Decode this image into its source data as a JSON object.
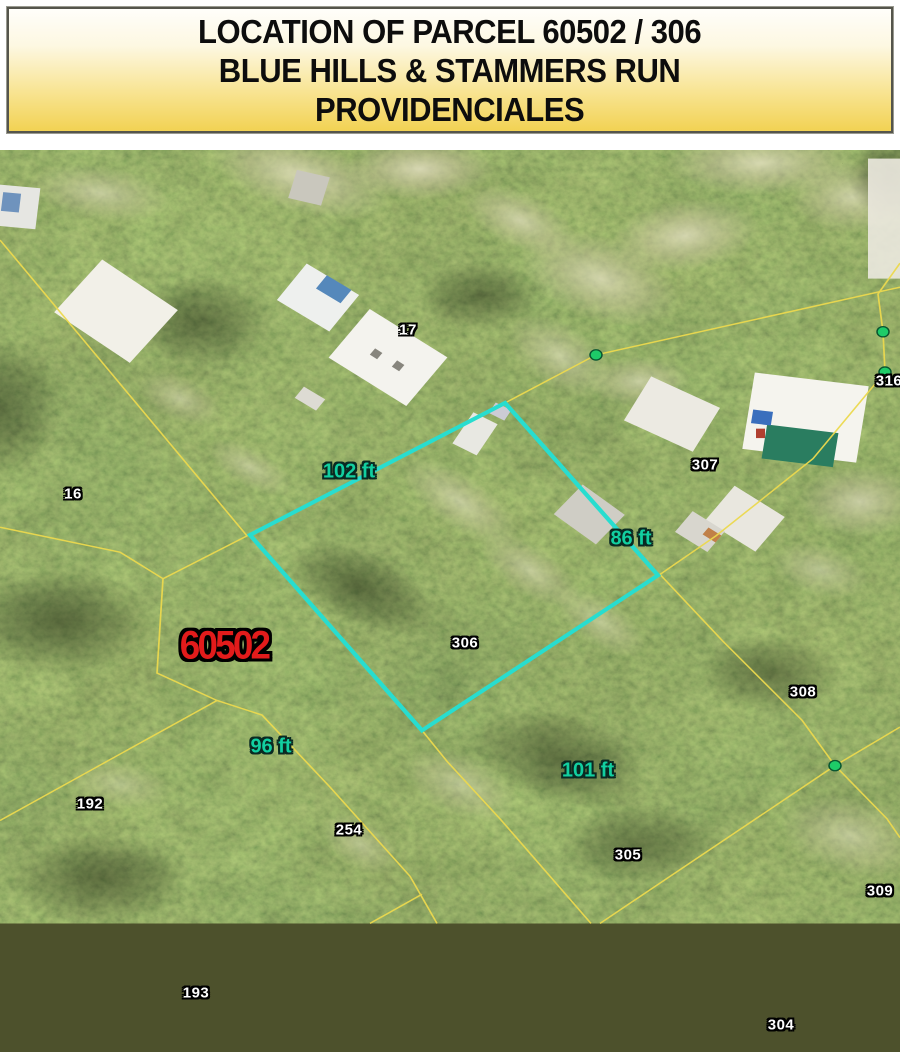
{
  "banner": {
    "line1": "LOCATION OF PARCEL 60502 / 306",
    "line2": "BLUE HILLS & STAMMERS RUN",
    "line3": "PROVIDENCIALES"
  },
  "map": {
    "parcel_id": "60502",
    "parcel_numbers": {
      "p16": "16",
      "p17": "17",
      "p192": "192",
      "p193": "193",
      "p254": "254",
      "p304": "304",
      "p305": "305",
      "p306": "306",
      "p307": "307",
      "p308": "308",
      "p309": "309",
      "p316": "316"
    },
    "measurements": {
      "top": "102 ft",
      "right": "86 ft",
      "left": "96 ft",
      "bottom": "101 ft"
    },
    "colors": {
      "parcel_outline": "#28ddcf",
      "boundary_lines": "#ecd94e",
      "survey_markers": "#1ecb68",
      "parcel_id_text": "#e21b1b",
      "measurement_text": "#12cfa0"
    }
  }
}
